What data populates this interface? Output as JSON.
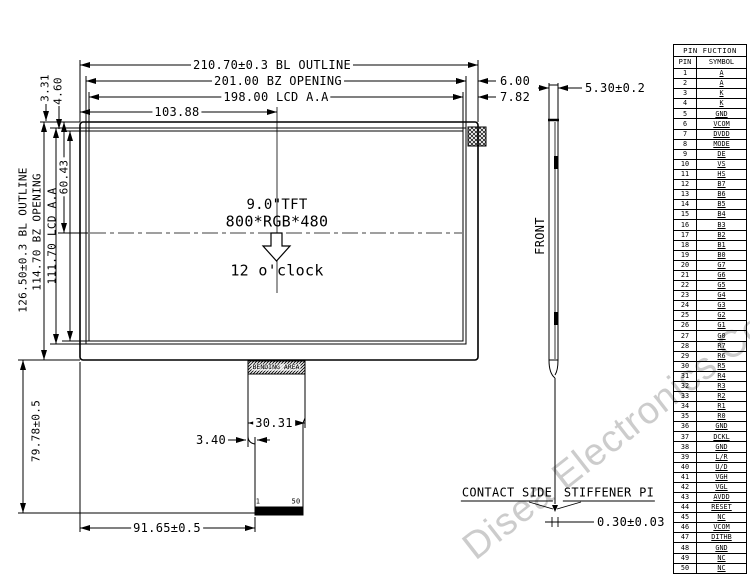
{
  "watermark": "Disea Electronics Co., Ltd",
  "front_view": {
    "size_label": "9.0\"TFT",
    "resolution": "800*RGB*480",
    "viewing_direction": "12 o'clock",
    "bending_area_label": "BENDING AREA",
    "contact_pin_first": "1",
    "contact_pin_last": "50"
  },
  "dimensions": {
    "bl_outline_width": "210.70±0.3 BL OUTLINE",
    "bz_opening_width": "201.00 BZ OPENING",
    "lcd_aa_width": "198.00 LCD A.A",
    "center_from_left": "103.88",
    "bz_right_margin": "6.00",
    "lcd_right_margin": "7.82",
    "bl_outline_height": "126.50±0.3 BL OUTLINE",
    "bz_opening_height": "114.70 BZ OPENING",
    "lcd_aa_height": "111.70 LCD A.A",
    "bz_top_margin": "3.31",
    "lcd_top_margin": "4.60",
    "center_from_top": "60.43",
    "fpc_length": "79.78±0.5",
    "fpc_width": "30.31",
    "fpc_left_offset": "3.40",
    "contact_from_left": "91.65±0.5",
    "module_thickness": "5.30±0.2",
    "stiffener_thickness": "0.30±0.03"
  },
  "side_view": {
    "front_label": "FRONT",
    "contact_side_label": "CONTACT SIDE",
    "stiffener_label": "STIFFENER PI"
  },
  "pin_table": {
    "title": "PIN FUCTION",
    "col_pin": "PIN",
    "col_symbol": "SYMBOL",
    "pins": [
      [
        "1",
        "A"
      ],
      [
        "2",
        "A"
      ],
      [
        "3",
        "K"
      ],
      [
        "4",
        "K"
      ],
      [
        "5",
        "GND"
      ],
      [
        "6",
        "VCOM"
      ],
      [
        "7",
        "DVDD"
      ],
      [
        "8",
        "MODE"
      ],
      [
        "9",
        "DE"
      ],
      [
        "10",
        "VS"
      ],
      [
        "11",
        "HS"
      ],
      [
        "12",
        "B7"
      ],
      [
        "13",
        "B6"
      ],
      [
        "14",
        "B5"
      ],
      [
        "15",
        "B4"
      ],
      [
        "16",
        "B3"
      ],
      [
        "17",
        "B2"
      ],
      [
        "18",
        "B1"
      ],
      [
        "19",
        "B0"
      ],
      [
        "20",
        "G7"
      ],
      [
        "21",
        "G6"
      ],
      [
        "22",
        "G5"
      ],
      [
        "23",
        "G4"
      ],
      [
        "24",
        "G3"
      ],
      [
        "25",
        "G2"
      ],
      [
        "26",
        "G1"
      ],
      [
        "27",
        "G0"
      ],
      [
        "28",
        "R7"
      ],
      [
        "29",
        "R6"
      ],
      [
        "30",
        "R5"
      ],
      [
        "31",
        "R4"
      ],
      [
        "32",
        "R3"
      ],
      [
        "33",
        "R2"
      ],
      [
        "34",
        "R1"
      ],
      [
        "35",
        "R0"
      ],
      [
        "36",
        "GND"
      ],
      [
        "37",
        "DCKL"
      ],
      [
        "38",
        "GND"
      ],
      [
        "39",
        "L/R"
      ],
      [
        "40",
        "U/D"
      ],
      [
        "41",
        "VGH"
      ],
      [
        "42",
        "VGL"
      ],
      [
        "43",
        "AVDD"
      ],
      [
        "44",
        "RESET"
      ],
      [
        "45",
        "NC"
      ],
      [
        "46",
        "VCOM"
      ],
      [
        "47",
        "DITHB"
      ],
      [
        "48",
        "GND"
      ],
      [
        "49",
        "NC"
      ],
      [
        "50",
        "NC"
      ]
    ]
  }
}
